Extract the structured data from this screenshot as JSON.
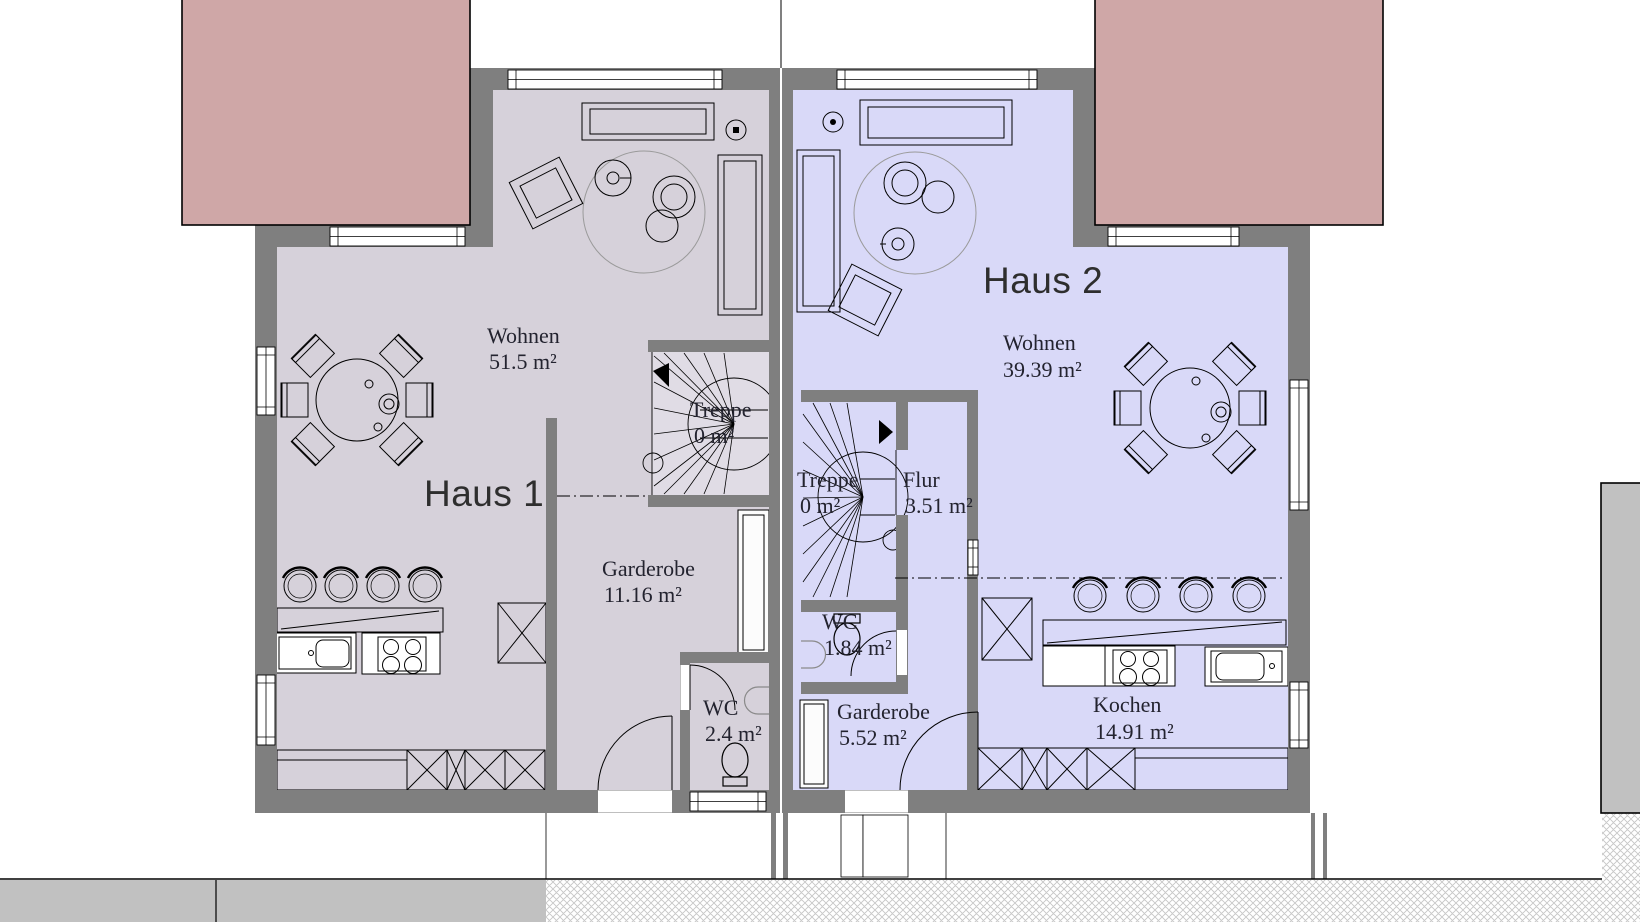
{
  "drawing": {
    "type": "floor-plan",
    "houses": [
      {
        "label": "Haus 1",
        "rooms": [
          {
            "name": "Wohnen",
            "area": "51.5 m²"
          },
          {
            "name": "Treppe",
            "area": "0 m²"
          },
          {
            "name": "Garderobe",
            "area": "11.16 m²"
          },
          {
            "name": "WC",
            "area": "2.4 m²"
          }
        ]
      },
      {
        "label": "Haus 2",
        "rooms": [
          {
            "name": "Wohnen",
            "area": "39.39 m²"
          },
          {
            "name": "Treppe",
            "area": "0 m²"
          },
          {
            "name": "Flur",
            "area": "3.51 m²"
          },
          {
            "name": "WC",
            "area": "1.84 m²"
          },
          {
            "name": "Garderobe",
            "area": "5.52 m²"
          },
          {
            "name": "Kochen",
            "area": "14.91 m²"
          }
        ]
      }
    ],
    "colors": {
      "wall": "#7f7f7f",
      "haus1_floor": "#d6d1da",
      "haus2_floor": "#d9d9f8",
      "roof": "#cfa7a7",
      "parcel_strip": "#c1c1c1",
      "stair_floor": "#e0dce5"
    }
  }
}
